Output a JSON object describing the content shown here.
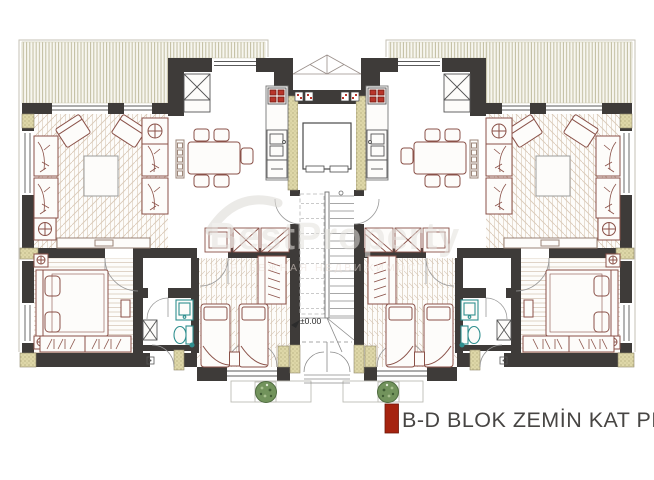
{
  "title_block": {
    "label": "B-D BLOK ZEMİN KAT PLANI",
    "accent_color": "#a5230f",
    "text_color": "#474543"
  },
  "annotations": {
    "level_marker": "±0.00"
  },
  "watermark": {
    "main": "BestProperty",
    "sub": "ЗАРУБЕЖНАЯ НЕДВИЖИМОСТЬ"
  },
  "palette": {
    "wall_dark": "#3e3b39",
    "insulation_khaki": "#ded7a8",
    "terrace_hatch": "#c1bda0",
    "floor_hatch": "#ddd1c2",
    "furniture_outline": "#8a5148",
    "bath_fixture_teal": "#2f8f8f",
    "stove_red": "#b8352a",
    "tree_green": "#72935c",
    "thin_line": "#8a8a8a"
  },
  "symbols": {
    "tree-icon": "landscaping tree (plan symbol)",
    "stove-icon": "4-burner cooktop",
    "lamp-table-icon": "circle-cross side table",
    "sink-icon": "kitchen/bath sink",
    "toilet-icon": "WC pan",
    "elevator-icon": "lift car in shaft",
    "stairs-icon": "stair flight with treads",
    "wardrobe-icon": "closet with hangers",
    "level-marker-icon": "datum flag"
  }
}
